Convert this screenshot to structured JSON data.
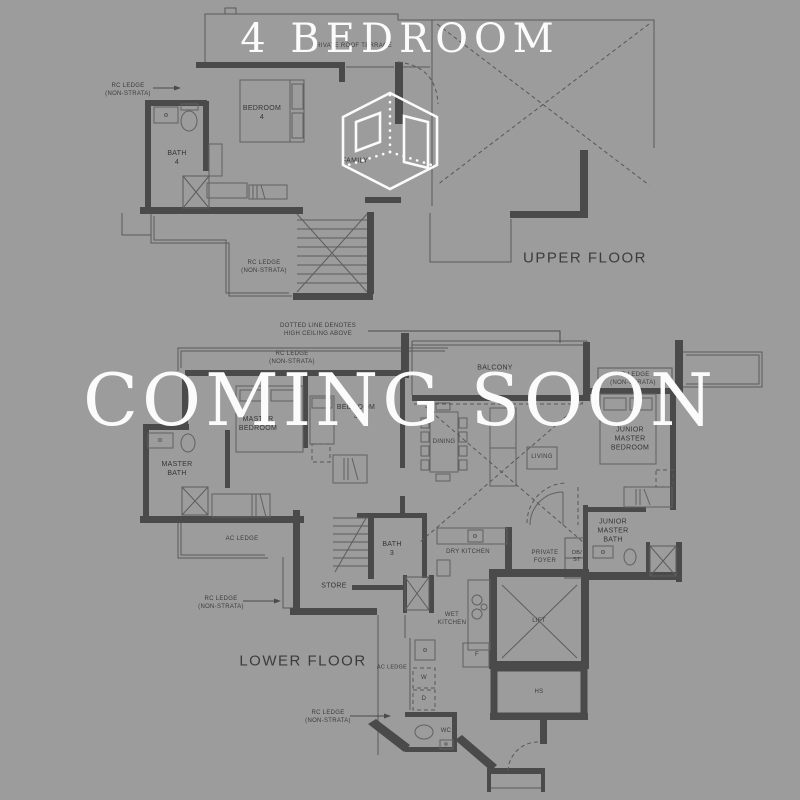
{
  "page": {
    "background_color": "#9c9c9c",
    "overlay_text_color": "#fbfbfb",
    "plan_line_color": "#4a4a4a"
  },
  "header": {
    "title": "4 BEDROOM"
  },
  "overlay": {
    "coming_soon": "COMING SOON"
  },
  "logo": {
    "name": "isometric-cube-logo"
  },
  "floorplan": {
    "upper_floor_title": "UPPER FLOOR",
    "lower_floor_title": "LOWER FLOOR",
    "labels": [
      {
        "name": "label-rc-ledge-upper-left",
        "lines": [
          "RC LEDGE",
          "(NON-STRATA)"
        ],
        "x": 128,
        "y": 91,
        "cls": "note"
      },
      {
        "name": "label-private-roof-terrace",
        "lines": [
          "PRIVATE ROOF TERRACE"
        ],
        "x": 352,
        "y": 47,
        "cls": "note"
      },
      {
        "name": "label-bedroom-4",
        "lines": [
          "BEDROOM",
          "4"
        ],
        "x": 262,
        "y": 113
      },
      {
        "name": "label-bath-4",
        "lines": [
          "BATH",
          "4"
        ],
        "x": 177,
        "y": 158
      },
      {
        "name": "label-family",
        "lines": [
          "FAMILY"
        ],
        "x": 355,
        "y": 161
      },
      {
        "name": "label-rc-ledge-upper-mid",
        "lines": [
          "RC LEDGE",
          "(NON-STRATA)"
        ],
        "x": 264,
        "y": 268,
        "cls": "note"
      },
      {
        "name": "upper-floor-title",
        "lines": [
          "UPPER FLOOR"
        ],
        "x": 585,
        "y": 258,
        "cls": "floor-title"
      },
      {
        "name": "label-high-ceiling-note",
        "lines": [
          "DOTTED LINE DENOTES",
          "HIGH CEILING ABOVE"
        ],
        "x": 318,
        "y": 331,
        "cls": "note"
      },
      {
        "name": "label-rc-ledge-lower-topleft",
        "lines": [
          "RC LEDGE",
          "(NON-STRATA)"
        ],
        "x": 292,
        "y": 359,
        "cls": "note"
      },
      {
        "name": "label-balcony",
        "lines": [
          "BALCONY"
        ],
        "x": 495,
        "y": 368
      },
      {
        "name": "label-rc-ledge-lower-right",
        "lines": [
          "RC LEDGE",
          "(NON-STRATA)"
        ],
        "x": 633,
        "y": 380,
        "cls": "note"
      },
      {
        "name": "label-master-bedroom",
        "lines": [
          "MASTER",
          "BEDROOM"
        ],
        "x": 258,
        "y": 424
      },
      {
        "name": "label-bedroom-3",
        "lines": [
          "BEDROOM",
          "3"
        ],
        "x": 356,
        "y": 412
      },
      {
        "name": "label-dining",
        "lines": [
          "DINING"
        ],
        "x": 444,
        "y": 443,
        "cls": "note"
      },
      {
        "name": "label-living",
        "lines": [
          "LIVING"
        ],
        "x": 542,
        "y": 458,
        "cls": "note"
      },
      {
        "name": "label-junior-master-bedroom",
        "lines": [
          "JUNIOR",
          "MASTER",
          "BEDROOM"
        ],
        "x": 630,
        "y": 439
      },
      {
        "name": "label-master-bath",
        "lines": [
          "MASTER",
          "BATH"
        ],
        "x": 177,
        "y": 469
      },
      {
        "name": "label-ac-ledge-left",
        "lines": [
          "AC LEDGE"
        ],
        "x": 242,
        "y": 540,
        "cls": "note"
      },
      {
        "name": "label-store",
        "lines": [
          "STORE"
        ],
        "x": 334,
        "y": 586
      },
      {
        "name": "label-bath-3",
        "lines": [
          "BATH",
          "3"
        ],
        "x": 392,
        "y": 549
      },
      {
        "name": "label-dry-kitchen",
        "lines": [
          "DRY KITCHEN"
        ],
        "x": 468,
        "y": 553,
        "cls": "note"
      },
      {
        "name": "label-private-foyer",
        "lines": [
          "PRIVATE",
          "FOYER"
        ],
        "x": 545,
        "y": 558,
        "cls": "note"
      },
      {
        "name": "label-db-st",
        "lines": [
          "DB/",
          "ST"
        ],
        "x": 577,
        "y": 557,
        "cls": "tiny"
      },
      {
        "name": "label-junior-master-bath",
        "lines": [
          "JUNIOR",
          "MASTER",
          "BATH"
        ],
        "x": 613,
        "y": 531
      },
      {
        "name": "label-rc-ledge-lower-midleft",
        "lines": [
          "RC LEDGE",
          "(NON-STRATA)"
        ],
        "x": 221,
        "y": 604,
        "cls": "note"
      },
      {
        "name": "lower-floor-title",
        "lines": [
          "LOWER FLOOR"
        ],
        "x": 303,
        "y": 661,
        "cls": "floor-title"
      },
      {
        "name": "label-ac-ledge-bottom",
        "lines": [
          "AC LEDGE"
        ],
        "x": 392,
        "y": 668,
        "cls": "tiny"
      },
      {
        "name": "label-washer",
        "lines": [
          "W"
        ],
        "x": 424,
        "y": 679,
        "cls": "note"
      },
      {
        "name": "label-dryer",
        "lines": [
          "D"
        ],
        "x": 424,
        "y": 700,
        "cls": "note"
      },
      {
        "name": "label-wet-kitchen",
        "lines": [
          "WET",
          "KITCHEN"
        ],
        "x": 452,
        "y": 620,
        "cls": "note"
      },
      {
        "name": "label-fridge",
        "lines": [
          "F"
        ],
        "x": 477,
        "y": 656,
        "cls": "note"
      },
      {
        "name": "label-lift",
        "lines": [
          "LIFT"
        ],
        "x": 539,
        "y": 622,
        "cls": "note"
      },
      {
        "name": "label-hs",
        "lines": [
          "HS"
        ],
        "x": 539,
        "y": 693,
        "cls": "note"
      },
      {
        "name": "label-rc-ledge-bottom",
        "lines": [
          "RC LEDGE",
          "(NON-STRATA)"
        ],
        "x": 328,
        "y": 718,
        "cls": "note"
      },
      {
        "name": "label-wc",
        "lines": [
          "WC"
        ],
        "x": 446,
        "y": 732,
        "cls": "note"
      }
    ]
  }
}
